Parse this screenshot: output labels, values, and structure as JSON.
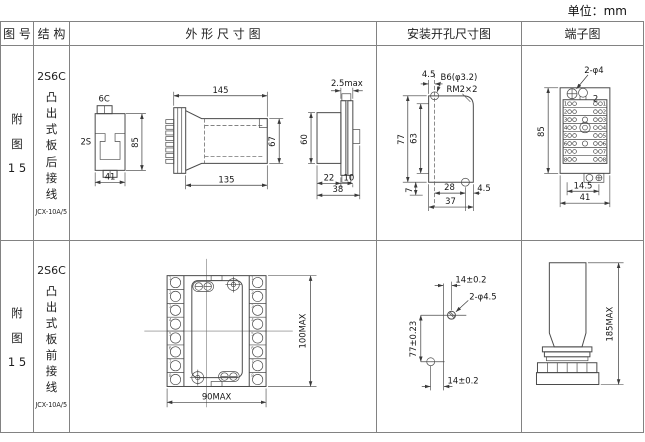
{
  "unit_label": "单位：mm",
  "header": {
    "figure_no": "图 号",
    "structure": "结 构",
    "outline": "外 形 尺 寸 图",
    "mounting": "安装开孔尺寸图",
    "terminal": "端子图"
  },
  "rows": [
    {
      "figure_no_chars": [
        "附",
        "图",
        "1 5"
      ],
      "structure": {
        "model": "2S6C",
        "mount_type": "凸出式板后接线",
        "product": "JCX-10A/5"
      },
      "outline": {
        "side_top": "6C",
        "side_left": "2S",
        "side_height": "85",
        "side_width": "41",
        "front_top": "145",
        "front_bottom": "135",
        "front_right": "67",
        "panel_top": "2.5max",
        "panel_left": "60",
        "panel_w1": "22",
        "panel_w2": "10",
        "panel_total": "38"
      },
      "mounting": {
        "top_offset": "4.5",
        "hole_label": "B6(φ3.2)",
        "corner_label": "RM2×2",
        "outer_h": "77",
        "inner_h": "63",
        "bottom_h": "7",
        "span": "28",
        "total_w": "37",
        "right_offset": "4.5"
      },
      "terminal": {
        "hole_label": "2-φ4",
        "pos_label": "2",
        "height": "85",
        "inner_w": "14.5",
        "total_w": "41",
        "row_numbers": [
          "1",
          "2",
          "3",
          "4",
          "5",
          "6",
          "7",
          "8"
        ]
      }
    },
    {
      "figure_no_chars": [
        "附",
        "图",
        "1 5"
      ],
      "structure": {
        "model": "2S6C",
        "mount_type": "凸出式板前接线",
        "product": "JCX-10A/5"
      },
      "outline": {
        "height": "100MAX",
        "width": "90MAX",
        "cell_numbers": [
          "1",
          "2",
          "3",
          "4",
          "5",
          "6",
          "7",
          "8"
        ]
      },
      "mounting": {
        "top_offset": "14±0.2",
        "hole_label": "2-φ4.5",
        "spacing": "77±0.23",
        "bottom_offset": "14±0.2"
      },
      "terminal": {
        "height": "185MAX"
      }
    }
  ]
}
